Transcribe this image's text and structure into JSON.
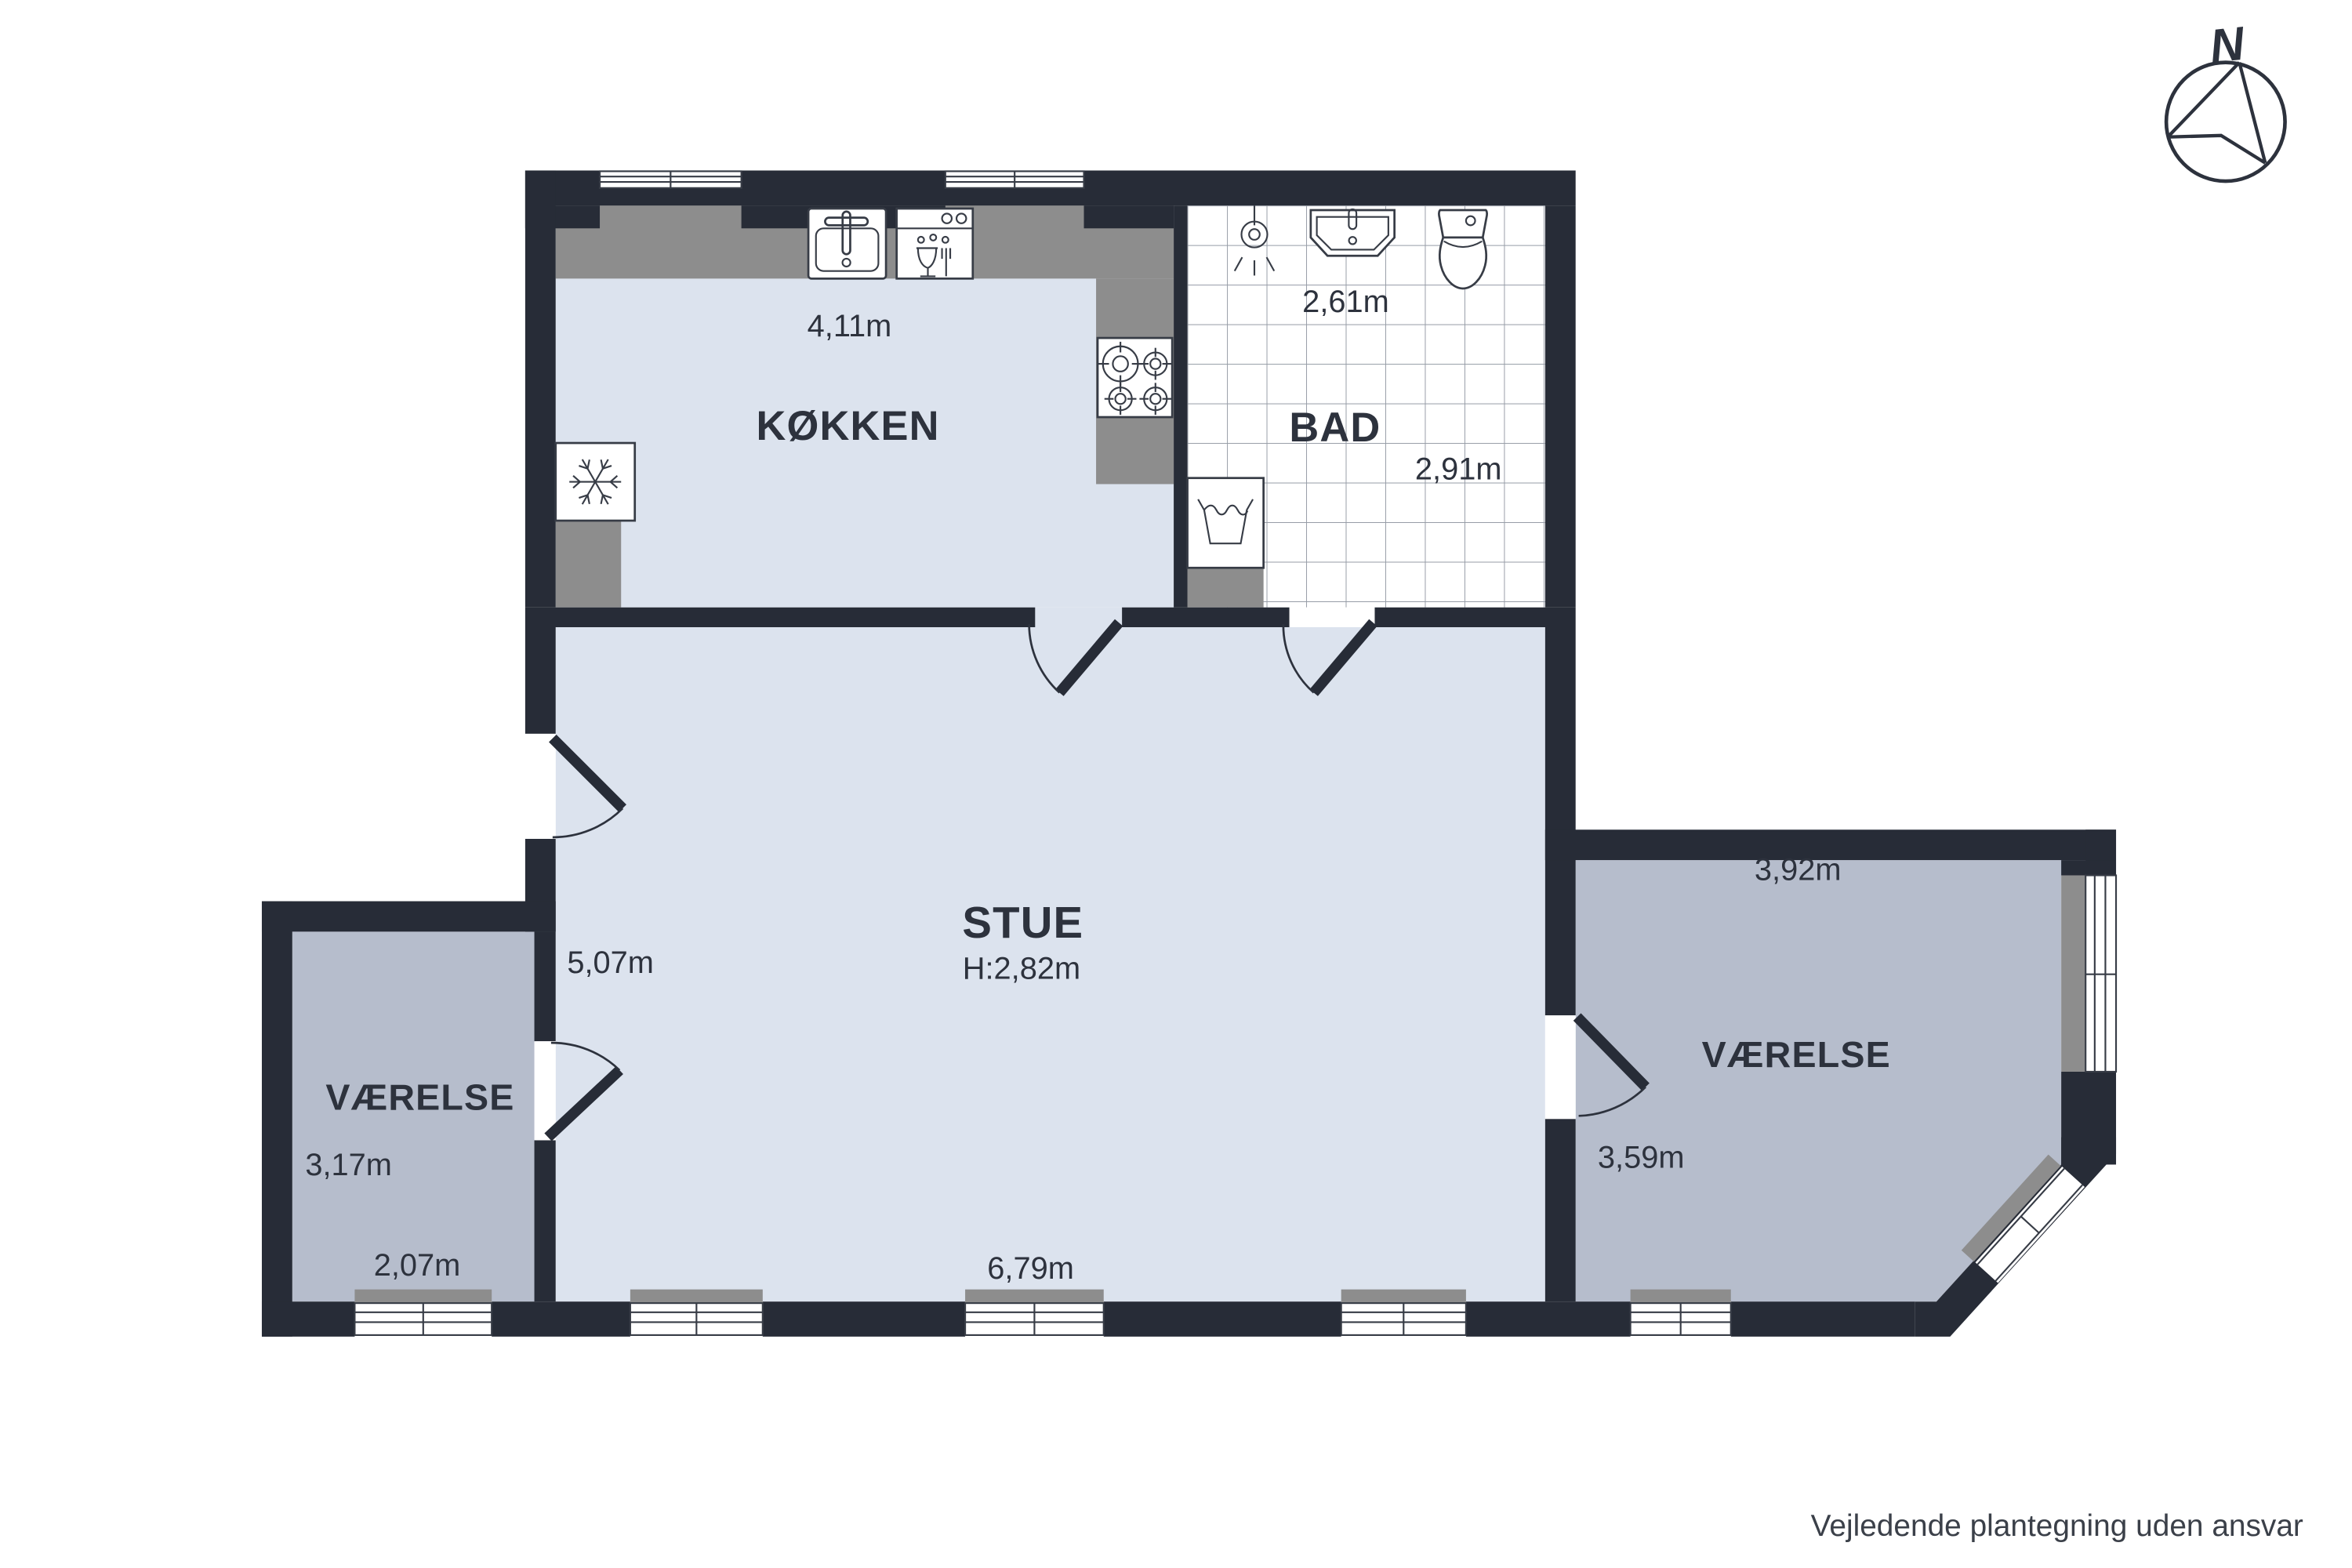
{
  "plan": {
    "compass_label": "N",
    "disclaimer": "Vejledende plantegning uden ansvar",
    "rooms": [
      {
        "id": "kokken",
        "label": "KØKKEN",
        "dims": {
          "top": "4,11m"
        }
      },
      {
        "id": "bad",
        "label": "BAD",
        "dims": {
          "top": "2,61m",
          "right": "2,91m"
        }
      },
      {
        "id": "stue",
        "label": "STUE",
        "ceiling_height": "H:2,82m",
        "dims": {
          "left": "5,07m",
          "bottom": "6,79m"
        }
      },
      {
        "id": "vaerelse_left",
        "label": "VÆRELSE",
        "dims": {
          "left": "3,17m",
          "bottom": "2,07m"
        }
      },
      {
        "id": "vaerelse_right",
        "label": "VÆRELSE",
        "dims": {
          "top": "3,92m",
          "left": "3,59m"
        }
      }
    ],
    "fixtures": [
      "fridge",
      "sink",
      "dishwasher",
      "stove",
      "washing-machine",
      "shower",
      "washbasin",
      "toilet"
    ],
    "colors": {
      "wall": "#272c37",
      "floor_light": "#dce3ee",
      "floor_room": "#b6bdcc",
      "counter": "#8d8d8d",
      "tile_line": "#969ca6",
      "line": "#373c46",
      "text": "#2d323d"
    }
  }
}
